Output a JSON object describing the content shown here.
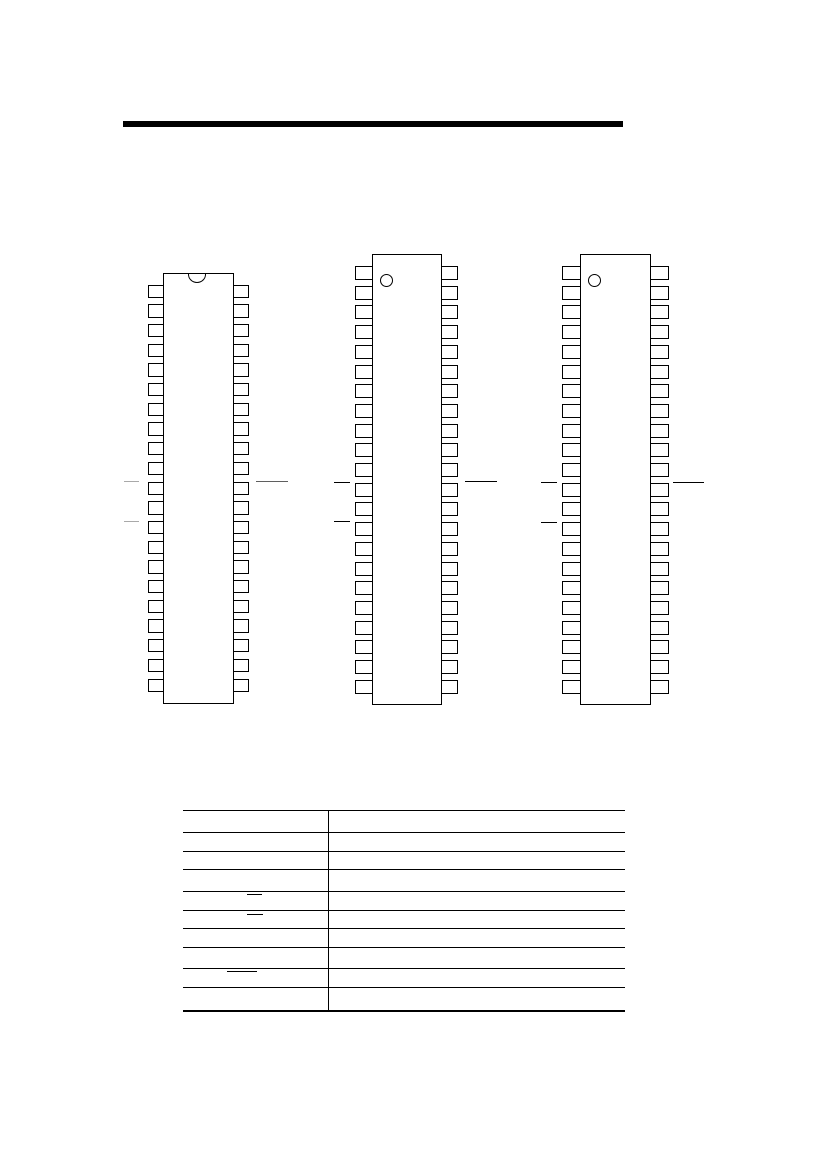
{
  "page": {
    "width": 826,
    "height": 1169,
    "background_color": "#ffffff"
  },
  "header": {
    "top_rule": {
      "x": 123,
      "y": 121,
      "width": 500,
      "height": 6,
      "color": "#000000"
    }
  },
  "ic_packages": [
    {
      "id": "dip-left",
      "orientation_marker": "top-notch",
      "pins_per_side": 21,
      "total_pins": 42,
      "body": {
        "x": 163,
        "y": 273,
        "width": 71,
        "height": 431
      },
      "notch": {
        "cx": 197,
        "width": 18,
        "height": 8.5
      },
      "pins": {
        "first_y": 284.5,
        "pitch": 19.7,
        "height": 13.4,
        "width": 16.5,
        "left_x": 148,
        "right_x": 232.8
      },
      "left_ticks": [
        {
          "x": 124,
          "y": 481,
          "width": 15,
          "color": "#a9a9a9"
        },
        {
          "x": 124,
          "y": 520.5,
          "width": 15,
          "color": "#a9a9a9"
        }
      ],
      "right_callout": {
        "x": 256,
        "y": 481,
        "width": 32,
        "color": "#5f5f5f"
      }
    },
    {
      "id": "dip-middle",
      "orientation_marker": "pin1-dot",
      "pins_per_side": 22,
      "total_pins": 44,
      "body": {
        "x": 372,
        "y": 254,
        "width": 69.5,
        "height": 451
      },
      "dot": {
        "x": 380,
        "y": 274,
        "diameter": 13.4
      },
      "pins": {
        "first_y": 266,
        "pitch": 19.7,
        "height": 14,
        "width": 18,
        "left_x": 355,
        "right_x": 440
      },
      "left_ticks": [
        {
          "x": 334,
          "y": 481.5,
          "width": 15.5,
          "color": "#000000"
        },
        {
          "x": 333.5,
          "y": 521,
          "width": 16,
          "color": "#000000"
        }
      ],
      "right_callout": {
        "x": 465,
        "y": 481,
        "width": 32,
        "color": "#000000"
      }
    },
    {
      "id": "dip-right",
      "orientation_marker": "pin1-dot",
      "pins_per_side": 22,
      "total_pins": 44,
      "body": {
        "x": 580,
        "y": 253.5,
        "width": 71,
        "height": 451.5
      },
      "dot": {
        "x": 587.5,
        "y": 274,
        "diameter": 13.4
      },
      "pins": {
        "first_y": 266,
        "pitch": 19.7,
        "height": 14,
        "width": 19,
        "left_x": 562,
        "right_x": 649.6
      },
      "left_ticks": [
        {
          "x": 541,
          "y": 481.5,
          "width": 16,
          "color": "#000000"
        },
        {
          "x": 541,
          "y": 521.5,
          "width": 16,
          "color": "#000000"
        }
      ],
      "right_callout": {
        "x": 673,
        "y": 481.5,
        "width": 31,
        "color": "#000000"
      }
    }
  ],
  "pin_table": {
    "x": 183,
    "width": 442,
    "row_count": 10,
    "column_count": 2,
    "row_line_ys": [
      810,
      832,
      851,
      869,
      891,
      910,
      928,
      947,
      968,
      987,
      1010
    ],
    "column_divider_x": 328,
    "line_color": "#000000",
    "signal_overlines": [
      {
        "x": 247,
        "y": 893.5,
        "width": 15
      },
      {
        "x": 247,
        "y": 914,
        "width": 16
      },
      {
        "x": 227,
        "y": 970.5,
        "width": 30
      }
    ]
  }
}
